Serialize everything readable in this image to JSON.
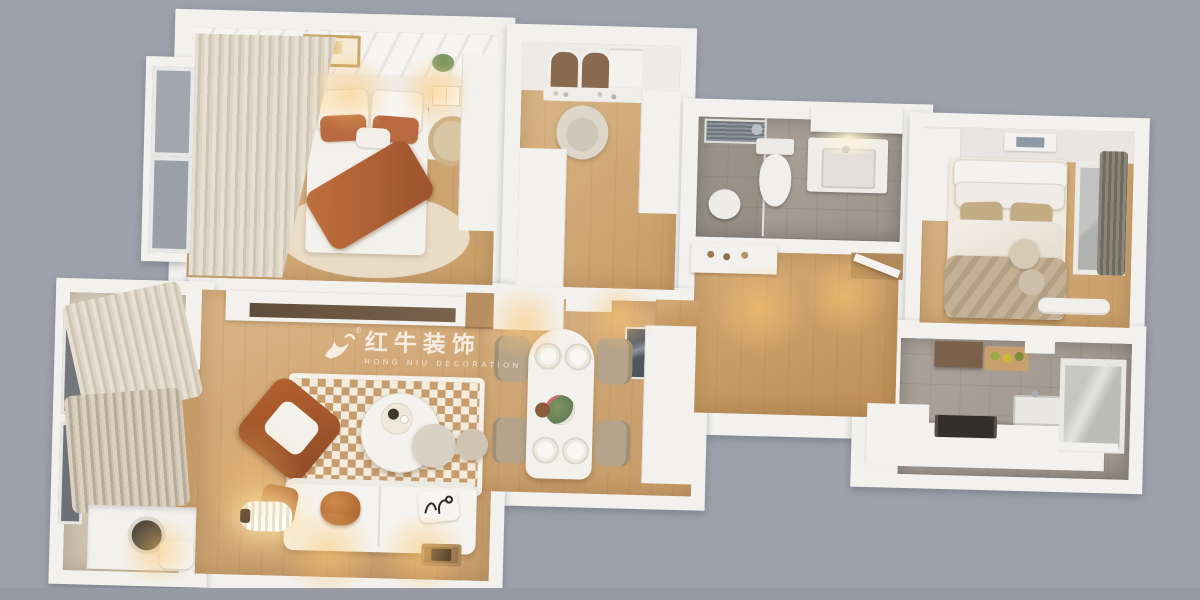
{
  "scene": {
    "type": "3d-floor-plan-render",
    "rooms": [
      "master-bedroom",
      "dressing-room",
      "bathroom",
      "bedroom-2",
      "hallway",
      "kitchen",
      "living-room",
      "dining-area",
      "balcony"
    ]
  },
  "watermark": {
    "registered_mark": "®",
    "title_cn": "红牛装饰",
    "subtitle_en": "HONG NIU DECORATION"
  },
  "palette": {
    "background": "#9da1ab",
    "wall_white": "#f2f1ee",
    "wood_light": "#d7b386",
    "wood_warm": "#c49a66",
    "tile_gray": "#a7a099",
    "accent_terracotta": "#b4612f",
    "textile_tan": "#c3ab84",
    "sofa_white": "#f5f3ef",
    "rug_check_tan": "#c79d6e",
    "glass_gray": "#a2a6ae"
  }
}
